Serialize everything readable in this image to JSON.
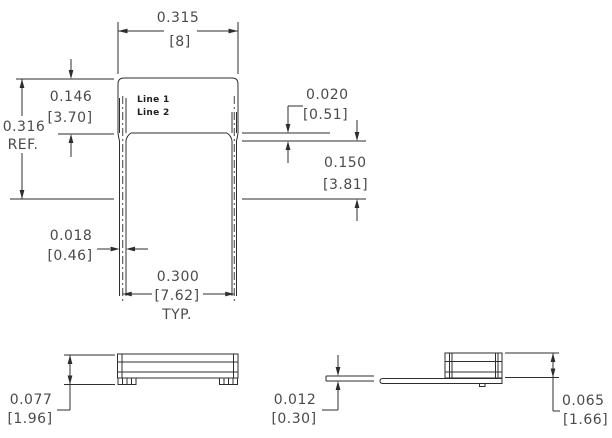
{
  "front": {
    "marking": {
      "line1": "Line 1",
      "line2": "Line 2"
    },
    "width": {
      "in": "0.315",
      "mm": "[8]"
    },
    "body_height": {
      "in": "0.146",
      "mm": "[3.70]"
    },
    "overall_height": {
      "in": "0.316",
      "note": "REF."
    },
    "standoff": {
      "in": "0.020",
      "mm": "[0.51]"
    },
    "lead_length": {
      "in": "0.150",
      "mm": "[3.81]"
    },
    "lead_thickness": {
      "in": "0.018",
      "mm": "[0.46]"
    },
    "lead_spacing": {
      "in": "0.300",
      "mm": "[7.62]",
      "note": "TYP."
    }
  },
  "side": {
    "seated_height": {
      "in": "0.077",
      "mm": "[1.96]"
    }
  },
  "end": {
    "lead_thickness": {
      "in": "0.012",
      "mm": "[0.30]"
    },
    "body_thickness": {
      "in": "0.065",
      "mm": "[1.66]"
    }
  },
  "colors": {
    "line": "#2d2d2d",
    "dimension_text": "#4a4a4a",
    "background": "#ffffff"
  }
}
